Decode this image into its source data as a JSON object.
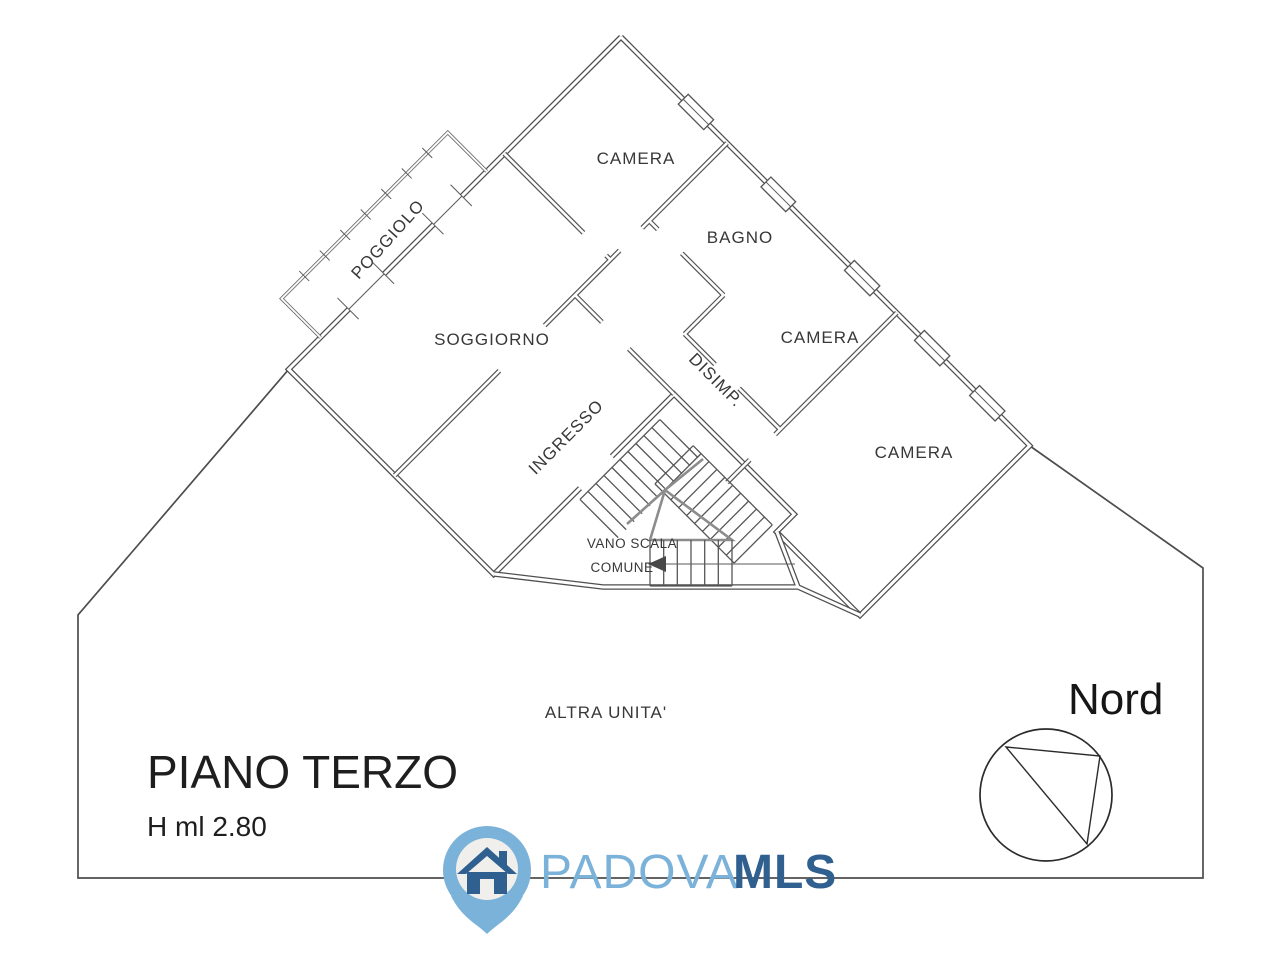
{
  "plan": {
    "rooms": {
      "camera_top": "CAMERA",
      "bagno": "BAGNO",
      "camera_mid": "CAMERA",
      "camera_low": "CAMERA",
      "soggiorno": "SOGGIORNO",
      "ingresso": "INGRESSO",
      "poggiolo": "POGGIOLO",
      "disimpegno": "DISIMP.",
      "stairwell_line1": "VANO SCALA",
      "stairwell_line2": "COMUNE",
      "other_unit": "ALTRA UNITA'"
    },
    "floor": {
      "title": "PIANO TERZO",
      "height": "H ml 2.80"
    },
    "compass": {
      "label": "Nord"
    }
  },
  "logo": {
    "name_part1": "PADOVA",
    "name_part2": "MLS",
    "color_light": "#7bb2d9",
    "color_dark": "#2f608f",
    "pin_inner": "#f0efec"
  },
  "icons": {
    "compass": "circle-with-inscribed-north-triangle",
    "logo_pin": "map-pin-with-house",
    "stairs_arrow": "left-direction-arrow"
  },
  "colors": {
    "wall": "#4f4f4f",
    "text": "#383838",
    "background": "#ffffff"
  }
}
